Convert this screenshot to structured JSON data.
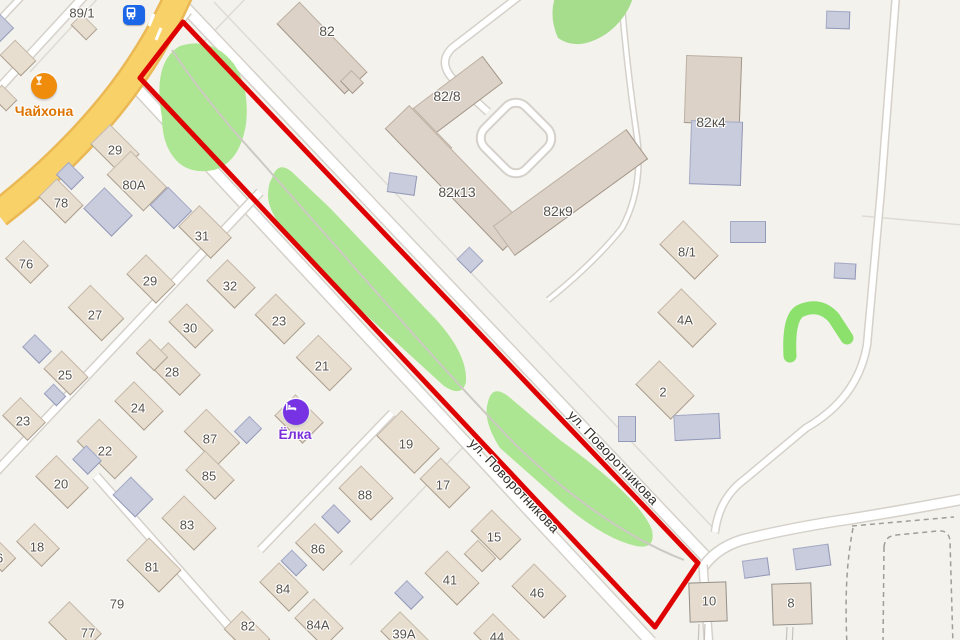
{
  "map": {
    "background_color": "#f4f2ed",
    "selection_outline_color": "#de0202",
    "street_label": "ул. Поворотникова",
    "pois": [
      {
        "id": "chaihona",
        "label": "Чайхона",
        "circle_color": "#f08c0c",
        "label_color": "#dd7300",
        "icon": "hookah-glass-icon",
        "x": 44,
        "y": 86,
        "label_x": 44,
        "label_y": 111,
        "label_size": 14
      },
      {
        "id": "yolka",
        "label": "Ёлка",
        "circle_color": "#7733e3",
        "label_color": "#7a2fd9",
        "icon": "hotel-bed-icon",
        "x": 296,
        "y": 412,
        "label_x": 295,
        "label_y": 434,
        "label_size": 14
      }
    ],
    "transit": {
      "id": "bus-stop",
      "icon": "bus-icon",
      "color": "#1c66e8",
      "x": 134,
      "y": 15
    },
    "labels": [
      {
        "t": "89/1",
        "x": 82,
        "y": 13
      },
      {
        "t": "82",
        "x": 327,
        "y": 31,
        "fs": 14
      },
      {
        "t": "82/8",
        "x": 447,
        "y": 96,
        "fs": 14
      },
      {
        "t": "82к13",
        "x": 457,
        "y": 192,
        "fs": 14
      },
      {
        "t": "82к9",
        "x": 558,
        "y": 211,
        "fs": 14
      },
      {
        "t": "82к4",
        "x": 711,
        "y": 122,
        "fs": 14
      },
      {
        "t": "29",
        "x": 115,
        "y": 150
      },
      {
        "t": "80A",
        "x": 134,
        "y": 185
      },
      {
        "t": "78",
        "x": 61,
        "y": 203
      },
      {
        "t": "31",
        "x": 202,
        "y": 236
      },
      {
        "t": "76",
        "x": 26,
        "y": 264
      },
      {
        "t": "29",
        "x": 150,
        "y": 281
      },
      {
        "t": "32",
        "x": 230,
        "y": 286
      },
      {
        "t": "27",
        "x": 95,
        "y": 315
      },
      {
        "t": "23",
        "x": 279,
        "y": 321
      },
      {
        "t": "30",
        "x": 190,
        "y": 328
      },
      {
        "t": "21",
        "x": 322,
        "y": 366
      },
      {
        "t": "28",
        "x": 172,
        "y": 372
      },
      {
        "t": "25",
        "x": 65,
        "y": 375
      },
      {
        "t": "24",
        "x": 138,
        "y": 408
      },
      {
        "t": "23",
        "x": 23,
        "y": 421
      },
      {
        "t": "87",
        "x": 210,
        "y": 439
      },
      {
        "t": "19",
        "x": 406,
        "y": 444
      },
      {
        "t": "22",
        "x": 105,
        "y": 451
      },
      {
        "t": "85",
        "x": 209,
        "y": 476
      },
      {
        "t": "20",
        "x": 61,
        "y": 484
      },
      {
        "t": "17",
        "x": 443,
        "y": 485
      },
      {
        "t": "88",
        "x": 365,
        "y": 495
      },
      {
        "t": "83",
        "x": 187,
        "y": 525
      },
      {
        "t": "15",
        "x": 494,
        "y": 537
      },
      {
        "t": "18",
        "x": 37,
        "y": 547
      },
      {
        "t": "86",
        "x": 318,
        "y": 549
      },
      {
        "t": "16",
        "x": -4,
        "y": 558
      },
      {
        "t": "81",
        "x": 152,
        "y": 567
      },
      {
        "t": "41",
        "x": 450,
        "y": 580
      },
      {
        "t": "84",
        "x": 283,
        "y": 589
      },
      {
        "t": "46",
        "x": 537,
        "y": 593
      },
      {
        "t": "10",
        "x": 709,
        "y": 601
      },
      {
        "t": "8",
        "x": 791,
        "y": 603
      },
      {
        "t": "79",
        "x": 117,
        "y": 604
      },
      {
        "t": "84A",
        "x": 318,
        "y": 625
      },
      {
        "t": "82",
        "x": 248,
        "y": 626
      },
      {
        "t": "77",
        "x": 88,
        "y": 633
      },
      {
        "t": "39A",
        "x": 404,
        "y": 634
      },
      {
        "t": "44",
        "x": 497,
        "y": 637
      },
      {
        "t": "8/1",
        "x": 687,
        "y": 252
      },
      {
        "t": "4A",
        "x": 685,
        "y": 320
      },
      {
        "t": "2",
        "x": 663,
        "y": 392
      },
      {
        "t": "ул. Поворотникова",
        "x": 613,
        "y": 458,
        "rot": 46.5,
        "cls": "street",
        "name": "street-name-label"
      },
      {
        "t": "ул. Поворотникова",
        "x": 514,
        "y": 486,
        "rot": 46.5,
        "cls": "street",
        "name": "street-name-label"
      }
    ],
    "buildings": [
      {
        "x": 84,
        "y": 27,
        "w": 22,
        "h": 16,
        "r": 45,
        "type": "h"
      },
      {
        "x": 18,
        "y": 58,
        "w": 30,
        "h": 22,
        "r": 45,
        "type": "h"
      },
      {
        "x": 4,
        "y": 98,
        "w": 22,
        "h": 16,
        "r": 45,
        "type": "h"
      },
      {
        "x": 115,
        "y": 149,
        "w": 42,
        "h": 28,
        "r": 45,
        "type": "h"
      },
      {
        "x": 137,
        "y": 181,
        "w": 52,
        "h": 34,
        "r": 45,
        "type": "h"
      },
      {
        "x": 61,
        "y": 201,
        "w": 38,
        "h": 26,
        "r": 45,
        "type": "h"
      },
      {
        "x": 205,
        "y": 232,
        "w": 46,
        "h": 30,
        "r": 45,
        "type": "h"
      },
      {
        "x": 27,
        "y": 262,
        "w": 36,
        "h": 26,
        "r": 45,
        "type": "h"
      },
      {
        "x": 151,
        "y": 279,
        "w": 42,
        "h": 28,
        "r": 45,
        "type": "h"
      },
      {
        "x": 96,
        "y": 313,
        "w": 48,
        "h": 32,
        "r": 45,
        "type": "h"
      },
      {
        "x": 231,
        "y": 284,
        "w": 40,
        "h": 30,
        "r": 45,
        "type": "h"
      },
      {
        "x": 191,
        "y": 326,
        "w": 38,
        "h": 26,
        "r": 45,
        "type": "h"
      },
      {
        "x": 66,
        "y": 373,
        "w": 38,
        "h": 26,
        "r": 45,
        "type": "h"
      },
      {
        "x": 174,
        "y": 369,
        "w": 46,
        "h": 30,
        "r": 45,
        "type": "h"
      },
      {
        "x": 152,
        "y": 355,
        "w": 26,
        "h": 20,
        "r": 45,
        "type": "h"
      },
      {
        "x": 139,
        "y": 406,
        "w": 42,
        "h": 28,
        "r": 45,
        "type": "h"
      },
      {
        "x": 24,
        "y": 419,
        "w": 36,
        "h": 26,
        "r": 45,
        "type": "h"
      },
      {
        "x": 280,
        "y": 319,
        "w": 42,
        "h": 30,
        "r": 45,
        "type": "h"
      },
      {
        "x": 324,
        "y": 363,
        "w": 48,
        "h": 32,
        "r": 45,
        "type": "h"
      },
      {
        "x": 299,
        "y": 419,
        "w": 40,
        "h": 30,
        "r": 45,
        "type": "h"
      },
      {
        "x": 107,
        "y": 449,
        "w": 54,
        "h": 32,
        "r": 45,
        "type": "h"
      },
      {
        "x": 212,
        "y": 437,
        "w": 48,
        "h": 32,
        "r": 45,
        "type": "h"
      },
      {
        "x": 210,
        "y": 475,
        "w": 42,
        "h": 28,
        "r": 45,
        "type": "h"
      },
      {
        "x": 62,
        "y": 482,
        "w": 46,
        "h": 30,
        "r": 45,
        "type": "h"
      },
      {
        "x": 38,
        "y": 545,
        "w": 36,
        "h": 26,
        "r": 45,
        "type": "h"
      },
      {
        "x": 189,
        "y": 523,
        "w": 46,
        "h": 32,
        "r": 45,
        "type": "h"
      },
      {
        "x": 154,
        "y": 565,
        "w": 46,
        "h": 32,
        "r": 45,
        "type": "h"
      },
      {
        "x": 75,
        "y": 628,
        "w": 46,
        "h": 30,
        "r": 45,
        "type": "h"
      },
      {
        "x": 0,
        "y": 556,
        "w": 26,
        "h": 20,
        "r": 45,
        "type": "h"
      },
      {
        "x": 319,
        "y": 547,
        "w": 40,
        "h": 28,
        "r": 45,
        "type": "h"
      },
      {
        "x": 284,
        "y": 587,
        "w": 42,
        "h": 28,
        "r": 45,
        "type": "h"
      },
      {
        "x": 319,
        "y": 623,
        "w": 42,
        "h": 28,
        "r": 45,
        "type": "h"
      },
      {
        "x": 247,
        "y": 634,
        "w": 40,
        "h": 26,
        "r": 45,
        "type": "h"
      },
      {
        "x": 366,
        "y": 493,
        "w": 46,
        "h": 32,
        "r": 45,
        "type": "h"
      },
      {
        "x": 405,
        "y": 636,
        "w": 42,
        "h": 28,
        "r": 45,
        "type": "h"
      },
      {
        "x": 452,
        "y": 578,
        "w": 46,
        "h": 32,
        "r": 45,
        "type": "h"
      },
      {
        "x": 480,
        "y": 556,
        "w": 26,
        "h": 20,
        "r": 45,
        "type": "h"
      },
      {
        "x": 445,
        "y": 483,
        "w": 42,
        "h": 30,
        "r": 45,
        "type": "h"
      },
      {
        "x": 496,
        "y": 535,
        "w": 42,
        "h": 30,
        "r": 45,
        "type": "h"
      },
      {
        "x": 408,
        "y": 442,
        "w": 54,
        "h": 36,
        "r": 45,
        "type": "h"
      },
      {
        "x": 498,
        "y": 638,
        "w": 42,
        "h": 28,
        "r": 45,
        "type": "h"
      },
      {
        "x": 539,
        "y": 591,
        "w": 46,
        "h": 32,
        "r": 45,
        "type": "h"
      },
      {
        "x": 689,
        "y": 250,
        "w": 50,
        "h": 34,
        "r": 45,
        "type": "h"
      },
      {
        "x": 687,
        "y": 318,
        "w": 50,
        "h": 34,
        "r": 45,
        "type": "h"
      },
      {
        "x": 665,
        "y": 390,
        "w": 50,
        "h": 34,
        "r": 45,
        "type": "h"
      },
      {
        "x": 708,
        "y": 602,
        "w": 38,
        "h": 40,
        "r": -2,
        "type": "h2"
      },
      {
        "x": 792,
        "y": 604,
        "w": 40,
        "h": 42,
        "r": -2,
        "type": "h2"
      },
      {
        "x": 322,
        "y": 48,
        "w": 98,
        "h": 32,
        "r": 46,
        "type": "c"
      },
      {
        "x": 352,
        "y": 82,
        "w": 18,
        "h": 16,
        "r": 46,
        "type": "c"
      },
      {
        "x": 448,
        "y": 103,
        "w": 112,
        "h": 34,
        "r": -37,
        "type": "c"
      },
      {
        "x": 422,
        "y": 138,
        "w": 56,
        "h": 30,
        "r": 46,
        "type": "c"
      },
      {
        "x": 456,
        "y": 178,
        "w": 170,
        "h": 34,
        "r": 46,
        "type": "c"
      },
      {
        "x": 570,
        "y": 192,
        "w": 165,
        "h": 37,
        "r": -36,
        "type": "c"
      },
      {
        "x": 713,
        "y": 90,
        "w": 56,
        "h": 68,
        "r": 2,
        "type": "c"
      },
      {
        "x": 716,
        "y": 153,
        "w": 52,
        "h": 64,
        "r": 2,
        "type": "b"
      },
      {
        "x": 70,
        "y": 176,
        "w": 22,
        "h": 18,
        "r": 45,
        "type": "b"
      },
      {
        "x": 108,
        "y": 212,
        "w": 40,
        "h": 30,
        "r": 45,
        "type": "b"
      },
      {
        "x": 171,
        "y": 208,
        "w": 34,
        "h": 26,
        "r": 45,
        "type": "b"
      },
      {
        "x": 0,
        "y": 28,
        "w": 20,
        "h": 20,
        "r": 45,
        "type": "b"
      },
      {
        "x": 37,
        "y": 349,
        "w": 24,
        "h": 18,
        "r": 45,
        "type": "b"
      },
      {
        "x": 55,
        "y": 395,
        "w": 18,
        "h": 14,
        "r": 45,
        "type": "b"
      },
      {
        "x": 133,
        "y": 497,
        "w": 32,
        "h": 26,
        "r": 45,
        "type": "b"
      },
      {
        "x": 87,
        "y": 460,
        "w": 22,
        "h": 20,
        "r": 45,
        "type": "b"
      },
      {
        "x": 248,
        "y": 430,
        "w": 18,
        "h": 22,
        "r": 45,
        "type": "b"
      },
      {
        "x": 294,
        "y": 563,
        "w": 22,
        "h": 16,
        "r": 45,
        "type": "b"
      },
      {
        "x": 336,
        "y": 519,
        "w": 24,
        "h": 18,
        "r": 45,
        "type": "b"
      },
      {
        "x": 409,
        "y": 595,
        "w": 24,
        "h": 18,
        "r": 45,
        "type": "b"
      },
      {
        "x": 402,
        "y": 184,
        "w": 28,
        "h": 20,
        "r": 8,
        "type": "b"
      },
      {
        "x": 470,
        "y": 260,
        "w": 20,
        "h": 18,
        "r": 45,
        "type": "b"
      },
      {
        "x": 748,
        "y": 232,
        "w": 36,
        "h": 22,
        "r": 0,
        "type": "b"
      },
      {
        "x": 845,
        "y": 271,
        "w": 22,
        "h": 16,
        "r": 3,
        "type": "b"
      },
      {
        "x": 697,
        "y": 427,
        "w": 46,
        "h": 26,
        "r": -3,
        "type": "b"
      },
      {
        "x": 627,
        "y": 429,
        "w": 18,
        "h": 26,
        "r": 0,
        "type": "b"
      },
      {
        "x": 756,
        "y": 568,
        "w": 26,
        "h": 18,
        "r": -8,
        "type": "b"
      },
      {
        "x": 812,
        "y": 557,
        "w": 36,
        "h": 22,
        "r": -8,
        "type": "b"
      },
      {
        "x": 838,
        "y": 20,
        "w": 24,
        "h": 18,
        "r": 2,
        "type": "b"
      }
    ]
  }
}
